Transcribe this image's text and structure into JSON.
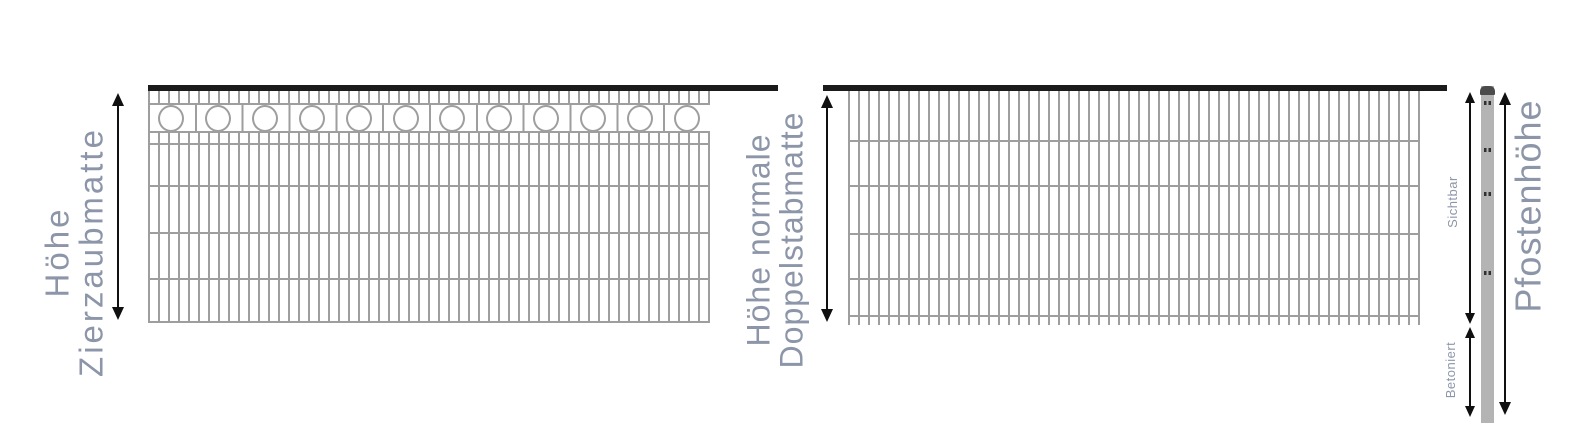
{
  "diagram_title": "Fence mat and post height comparison",
  "labels": {
    "decorative": {
      "line1": "Höhe",
      "line2": "Zierzaubmatte"
    },
    "standard": {
      "line1": "Höhe normale",
      "line2": "Doppelstabmatte"
    },
    "post_visible": "Sichtbar",
    "post_concreted": "Betoniert",
    "post_height": "Pfostenhöhe"
  },
  "figures": {
    "decorative_fence": {
      "ornament_ring_count": 12
    }
  },
  "colors": {
    "label": "#8d96a9",
    "bar": "#9e9e9e",
    "dark": "#1b1b1b",
    "arrow": "#101010",
    "post": "#b4b4b4",
    "cap": "#4b4b4b",
    "clamp": "#303030"
  }
}
